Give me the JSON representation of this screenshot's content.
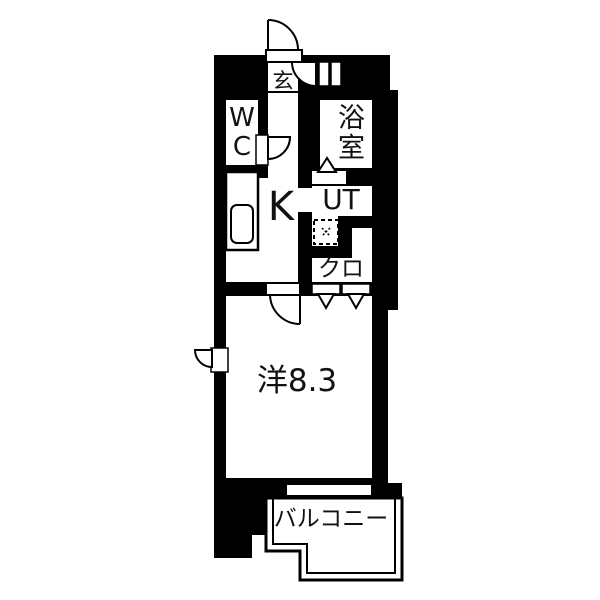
{
  "floorplan": {
    "colors": {
      "wall": "#000000",
      "floor": "#ffffff"
    },
    "rooms": {
      "entrance": {
        "label": "玄"
      },
      "toilet": {
        "label": "WC"
      },
      "bath": {
        "label": "浴室"
      },
      "kitchen": {
        "label": "K"
      },
      "utility": {
        "label": "UT"
      },
      "closet": {
        "label": "クロ"
      },
      "western_room": {
        "label": "洋8.3"
      },
      "balcony": {
        "label": "バルコニー"
      }
    }
  }
}
